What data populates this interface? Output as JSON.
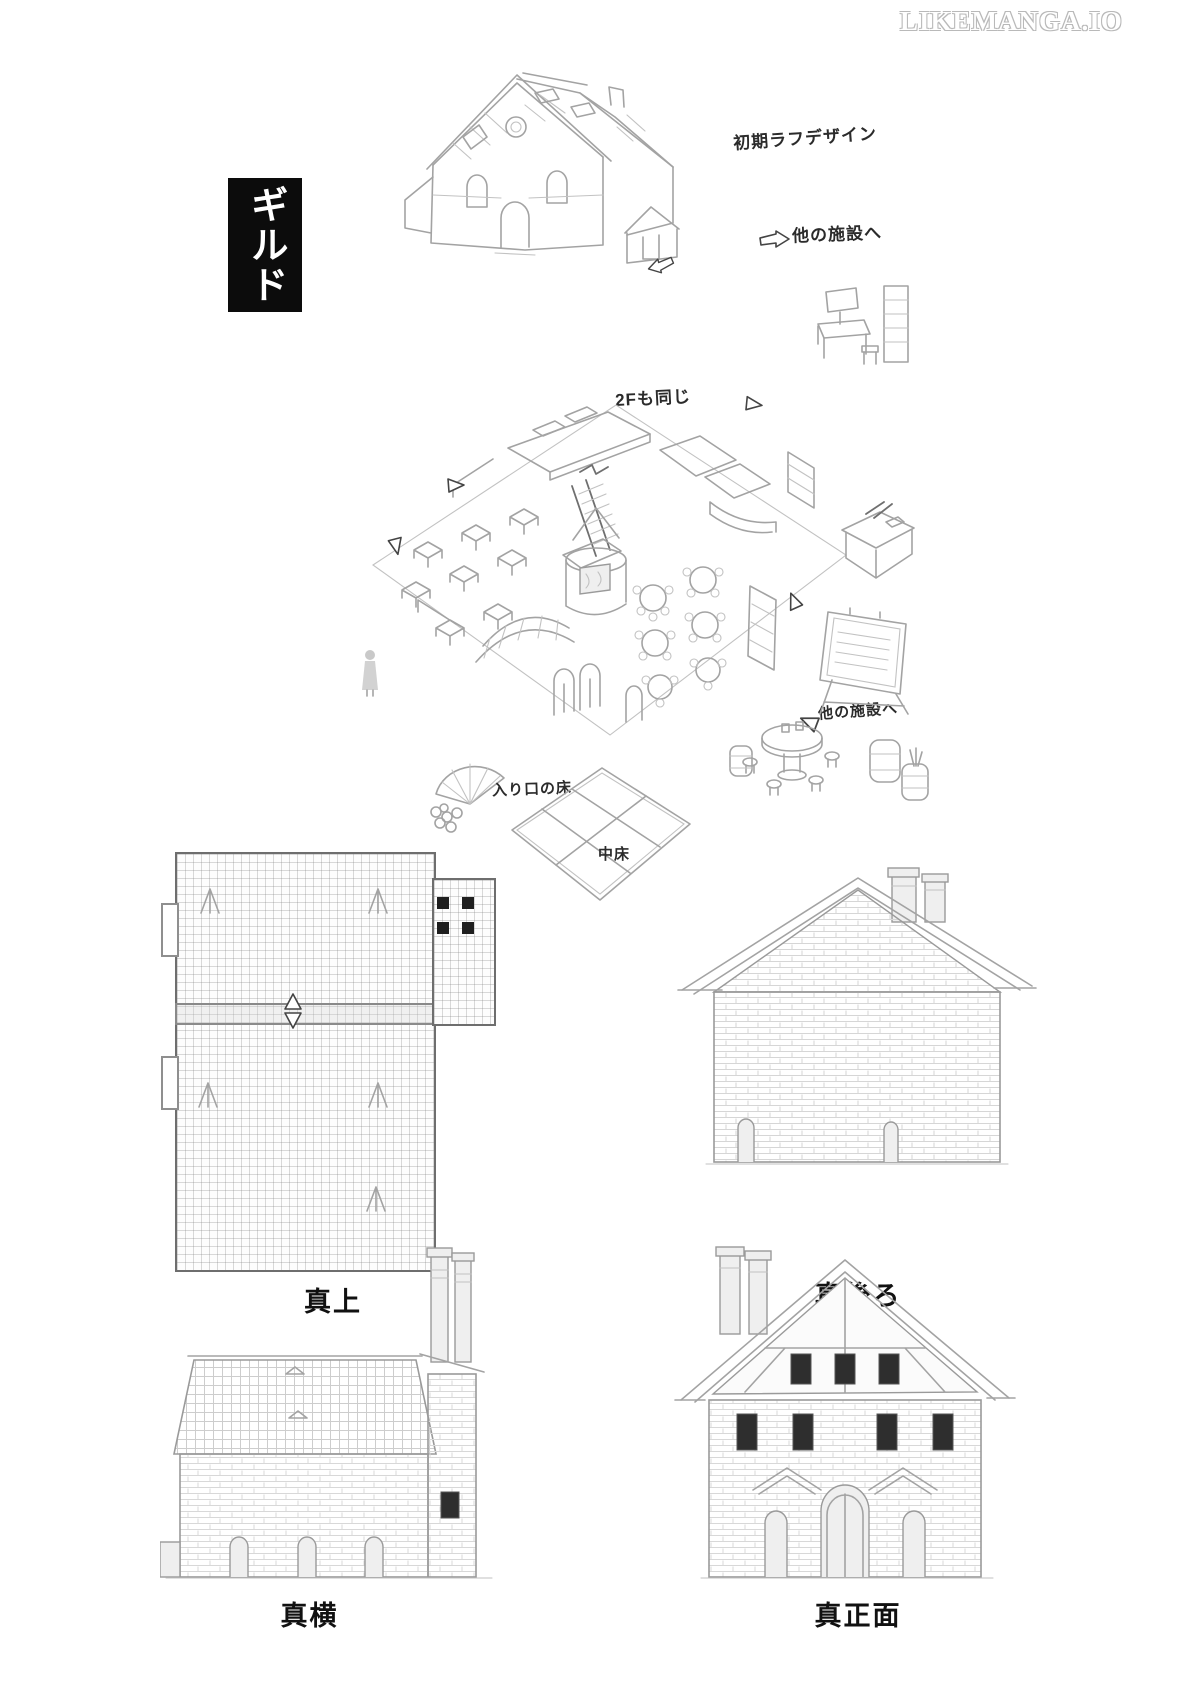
{
  "watermark": {
    "text": "LIKEMANGA.IO"
  },
  "title_box": {
    "text": "ギルド",
    "bg": "#0c0c0c",
    "fg": "#ffffff"
  },
  "annotations": {
    "initial_rough_design": "初期ラフデザイン",
    "to_other_facilities_top": "他の施設へ",
    "second_floor_same": "2Fも同じ",
    "to_other_facilities_mid": "他の施設へ",
    "entrance_floor": "入り口の床",
    "center_floor": "中床"
  },
  "views": [
    {
      "id": "top",
      "label": "真上"
    },
    {
      "id": "back",
      "label": "真後ろ"
    },
    {
      "id": "side",
      "label": "真横"
    },
    {
      "id": "front",
      "label": "真正面"
    }
  ],
  "colors": {
    "sketch": "#a3a3a3",
    "ink": "#1a1a1a",
    "paper": "#ffffff"
  }
}
